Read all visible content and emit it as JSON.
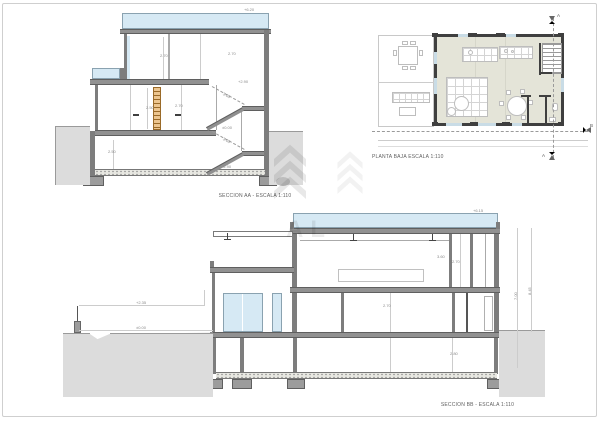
{
  "drawings": {
    "seccion_aa": {
      "caption": "SECCION AA - ESCALA 1:110"
    },
    "planta_baja": {
      "caption": "PLANTA BAJA ESCALA 1:110"
    },
    "seccion_bb": {
      "caption": "SECCION BB - ESCALA 1:110"
    }
  },
  "section_markers": {
    "a_top": "A",
    "a_bottom": "A",
    "b_right": "B"
  },
  "watermark": {
    "text": "AL",
    "logo": "chevron-logo"
  },
  "colors": {
    "glass": "#d6e9f4",
    "slab": "#919191",
    "wall": "#7d7d7d",
    "plan_wall": "#3f3f3f",
    "terrain": "#dcdcdc",
    "plan_floor": "#e4e4d8",
    "ladder": "#ecc58f"
  },
  "dims": {
    "aa": [
      "+6.20",
      "2.70",
      "2.70",
      "+2.90",
      "2.50",
      "2.70",
      "2.50",
      "±0.00",
      "-2.90",
      "3.05",
      "3.05"
    ],
    "bb": [
      "+6.15",
      "3.60",
      "2.70",
      "2.70",
      "2.80",
      "+2.35",
      "±0.00",
      "7.00",
      "8.45"
    ]
  }
}
